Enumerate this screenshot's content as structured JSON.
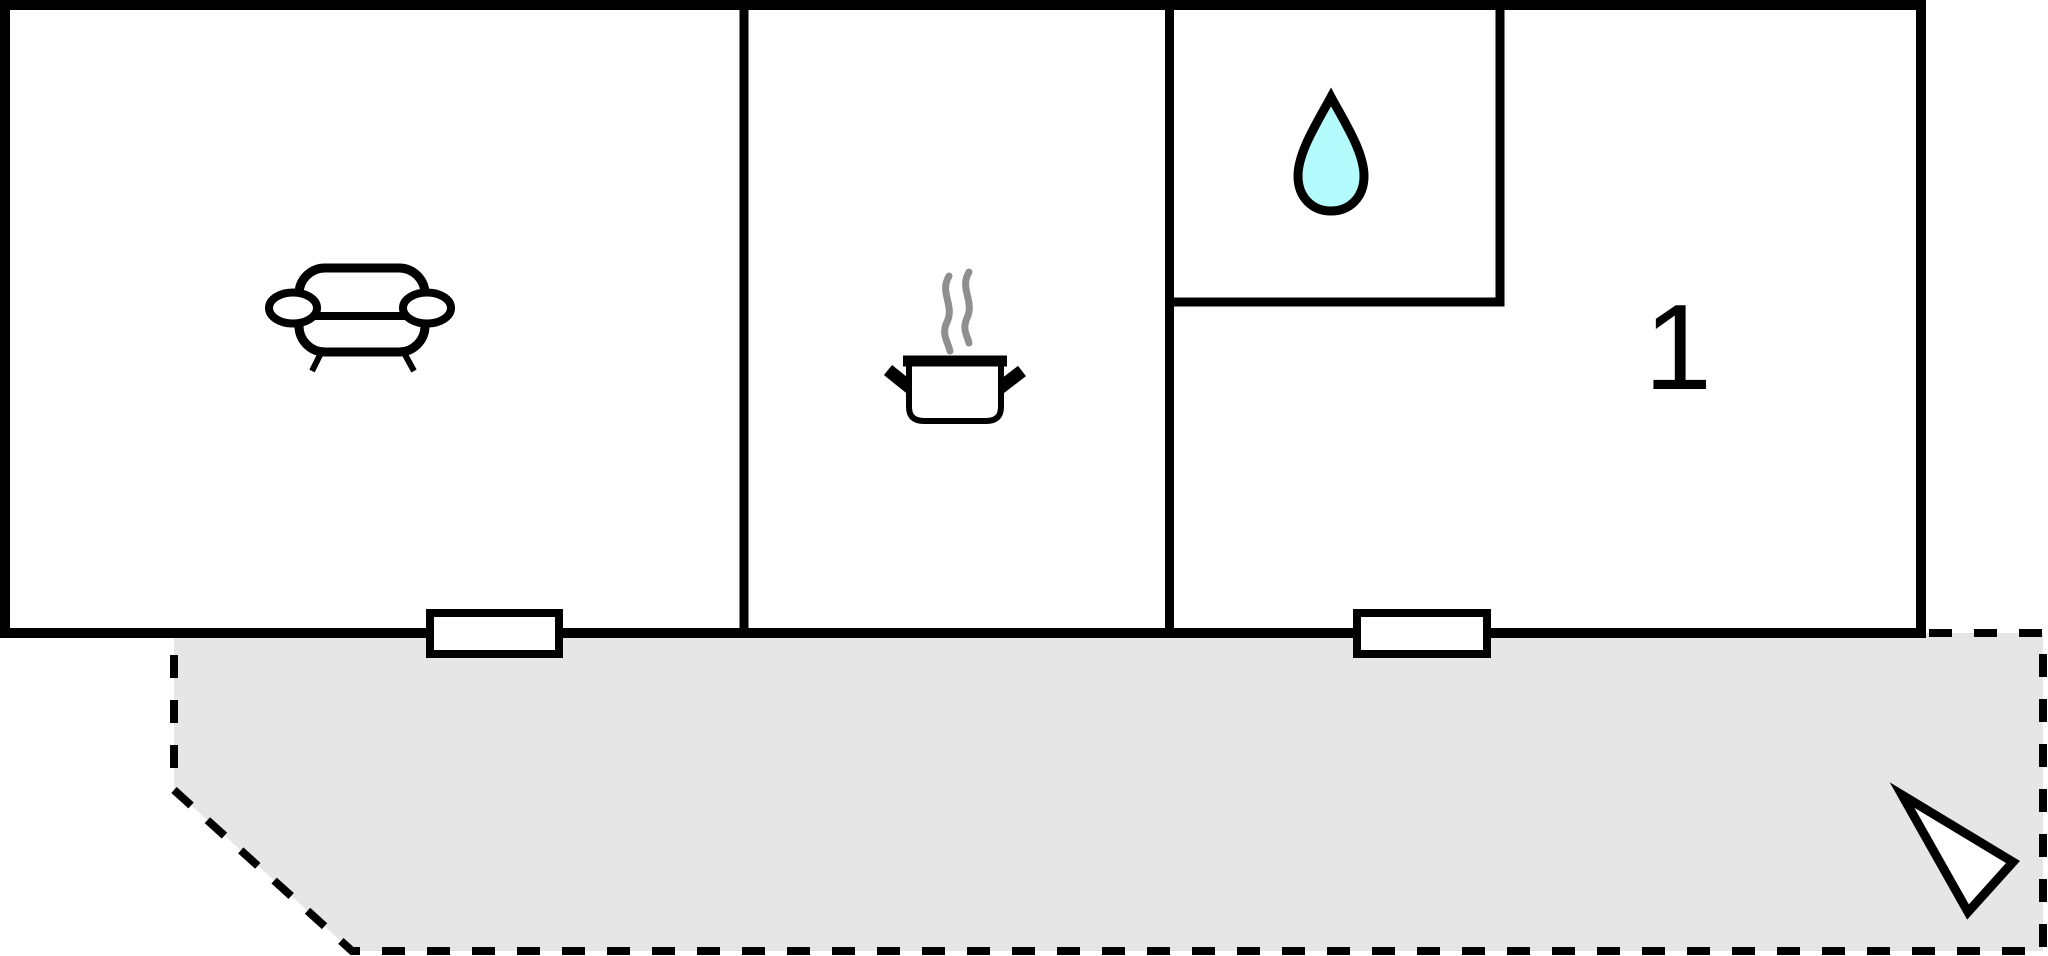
{
  "plan": {
    "kind": "floor-plan",
    "door_count": 2
  },
  "rooms": {
    "living_room": {
      "icon": "sofa-icon"
    },
    "kitchen": {
      "icon": "cooking-pot-icon"
    },
    "bathroom": {
      "icon": "water-drop-icon"
    },
    "bedroom": {
      "label": "1"
    }
  },
  "terrace": {
    "outline": "dashed"
  },
  "compass": {
    "icon": "north-arrow-icon"
  },
  "colors": {
    "wall": "#000000",
    "floor": "#ffffff",
    "terrace_fill": "#e6e6e6",
    "drop_fill": "#b3fbfd",
    "steam": "#8f8f8f",
    "arrow_fill": "#ffffff"
  }
}
